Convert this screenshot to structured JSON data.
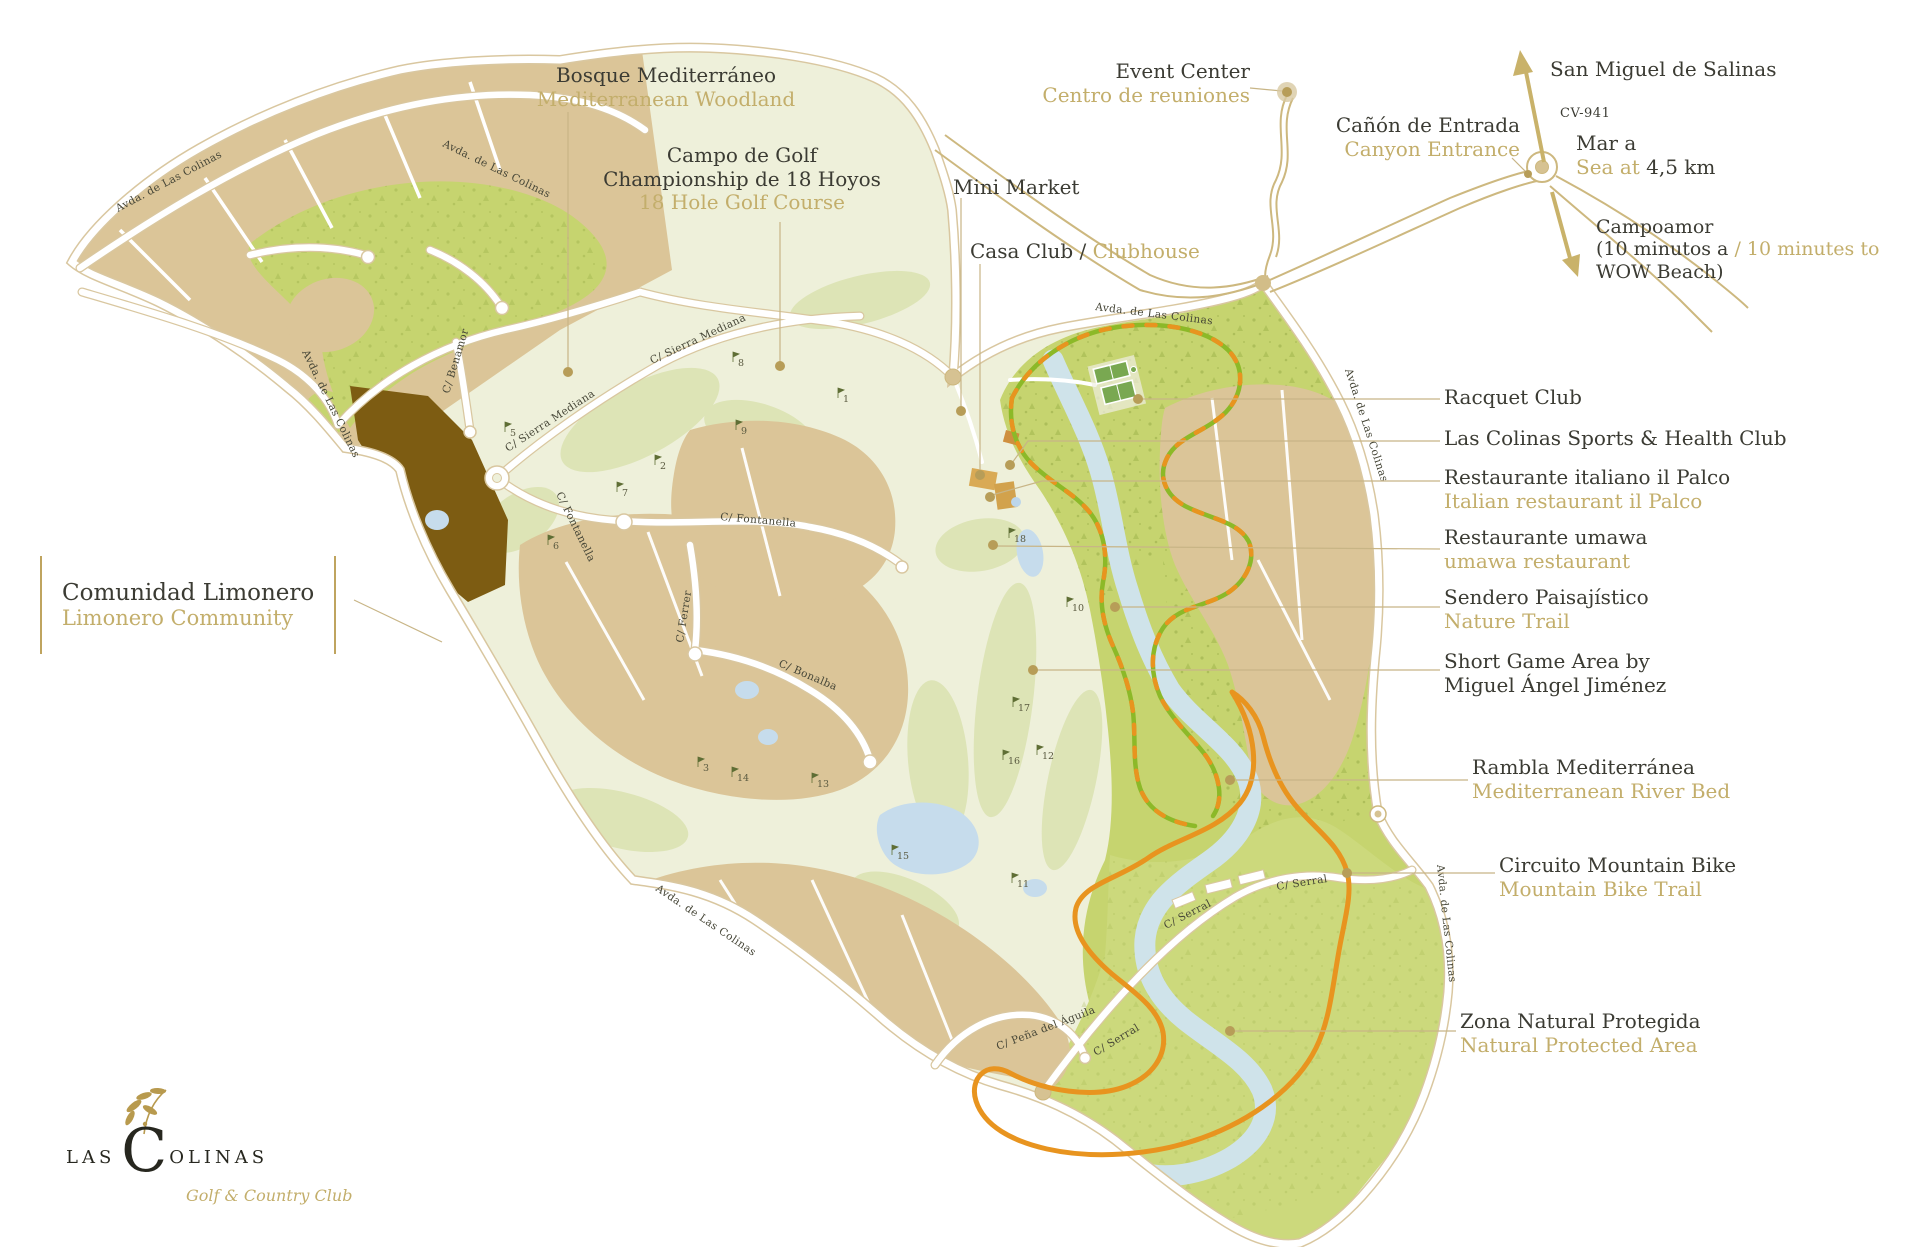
{
  "title": "Las Colinas Golf & Country Club — resort map",
  "logo": {
    "word1": "LAS",
    "big_letter": "C",
    "word2": "OLINAS",
    "tagline": "Golf & Country Club"
  },
  "labels": {
    "bosque": {
      "es": "Bosque Mediterráneo",
      "en": "Mediterranean Woodland"
    },
    "campo": {
      "line1": "Campo de Golf",
      "line2": "Championship de 18 Hoyos",
      "en": "18 Hole Golf Course"
    },
    "mini_market": {
      "en": "Mini Market"
    },
    "casa_club": {
      "es": "Casa Club / ",
      "en": "Clubhouse"
    },
    "event_center": {
      "en": "Event Center",
      "es": "Centro de reuniones"
    },
    "canyon": {
      "es": "Cañón de Entrada",
      "en": "Canyon Entrance"
    },
    "san_miguel": {
      "text": "San Miguel de Salinas"
    },
    "road_cv941": {
      "text": "CV-941"
    },
    "sea": {
      "es": "Mar a",
      "en": "Sea at",
      "distance": " 4,5 km"
    },
    "campoamor": {
      "line1": "Campoamor",
      "line2_dark": "(10 minutos a ",
      "line2_gold": "/ 10 minutes to",
      "line3": "WOW Beach)"
    },
    "racquet": {
      "en": "Racquet Club"
    },
    "sports": {
      "en": "Las Colinas Sports & Health Club"
    },
    "palco": {
      "es": "Restaurante italiano il Palco",
      "en": "Italian restaurant il Palco"
    },
    "umawa": {
      "es": "Restaurante umawa",
      "en": "umawa restaurant"
    },
    "sendero": {
      "es": "Sendero Paisajístico",
      "en": "Nature Trail"
    },
    "short_game": {
      "line1": "Short Game Area by",
      "line2": "Miguel Ángel Jiménez"
    },
    "rambla": {
      "es": "Rambla Mediterránea",
      "en": "Mediterranean River Bed"
    },
    "circuito": {
      "es": "Circuito Mountain Bike",
      "en": "Mountain Bike Trail"
    },
    "zona": {
      "es": "Zona Natural Protegida",
      "en": "Natural Protected Area"
    },
    "limonero": {
      "es": "Comunidad Limonero",
      "en": "Limonero Community"
    }
  },
  "streets": {
    "avda": "Avda. de Las Colinas",
    "sierra": "C/ Sierra Mediana",
    "fontanella": "C/ Fontanella",
    "ferrer": "C/ Ferrer",
    "bonalba": "C/ Bonalba",
    "benamor": "C/ Benamor",
    "serral": "C/ Serral",
    "pena": "C/ Peña del Águila"
  },
  "golf_holes": [
    {
      "n": "1",
      "x": 838,
      "y": 396
    },
    {
      "n": "2",
      "x": 655,
      "y": 463
    },
    {
      "n": "3",
      "x": 698,
      "y": 765
    },
    {
      "n": "5",
      "x": 505,
      "y": 430
    },
    {
      "n": "6",
      "x": 548,
      "y": 543
    },
    {
      "n": "7",
      "x": 617,
      "y": 490
    },
    {
      "n": "8",
      "x": 733,
      "y": 360
    },
    {
      "n": "9",
      "x": 736,
      "y": 428
    },
    {
      "n": "10",
      "x": 1067,
      "y": 605
    },
    {
      "n": "11",
      "x": 1012,
      "y": 881
    },
    {
      "n": "12",
      "x": 1037,
      "y": 753
    },
    {
      "n": "13",
      "x": 812,
      "y": 781
    },
    {
      "n": "14",
      "x": 732,
      "y": 775
    },
    {
      "n": "15",
      "x": 892,
      "y": 853
    },
    {
      "n": "16",
      "x": 1003,
      "y": 758
    },
    {
      "n": "17",
      "x": 1013,
      "y": 705
    },
    {
      "n": "18",
      "x": 1009,
      "y": 536
    }
  ],
  "colors": {
    "gold_text": "#c3ae6b",
    "dark_text": "#3b3b33",
    "parcel_beige": "#dbc598",
    "woodland_green": "#c6d46f",
    "protected_green": "#ccd97c",
    "golf_pale": "#eef0da",
    "fairway": "#dde4b6",
    "river_blue": "#cfe3ea",
    "brown_area": "#7d5c12",
    "trail_orange": "#e8941f",
    "trail_green": "#8cb928",
    "road_gold": "#cdb87f",
    "marker_gold": "#b79d58"
  }
}
